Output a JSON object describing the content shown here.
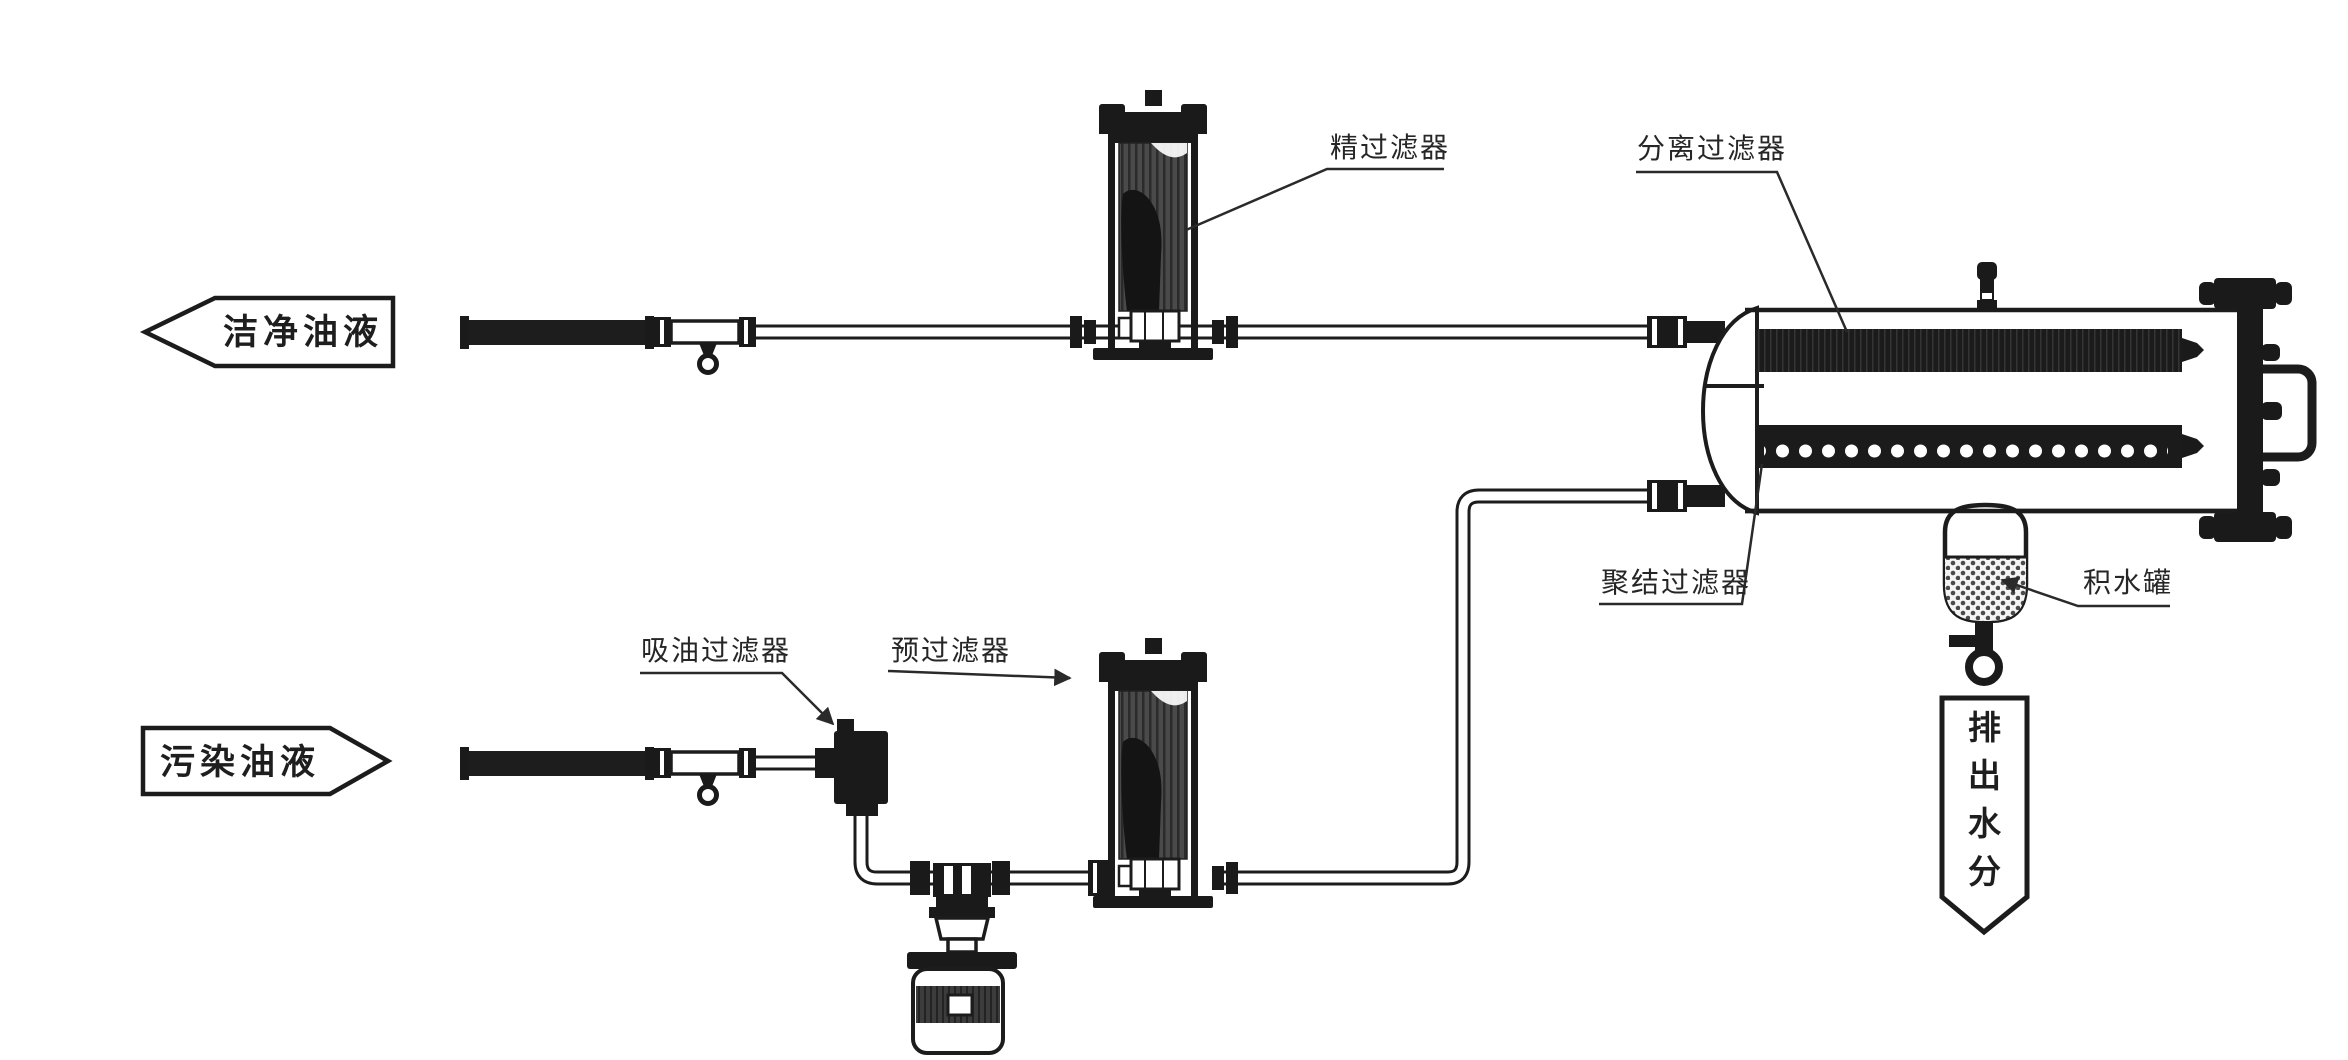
{
  "diagram": {
    "type": "oil-purification-flow-diagram",
    "banners": {
      "clean_oil": {
        "label": "洁净油液",
        "direction": "left"
      },
      "contaminated_oil": {
        "label": "污染油液",
        "direction": "right"
      },
      "discharge_water": {
        "label": "排出水分",
        "direction": "down"
      }
    },
    "labels": {
      "fine_filter": "精过滤器",
      "separation_filter": "分离过滤器",
      "suction_filter": "吸油过滤器",
      "pre_filter": "预过滤器",
      "coalescing_filter": "聚结过滤器",
      "water_tank": "积水罐"
    },
    "colors": {
      "line": "#1c1c1c",
      "fill_dark": "#1a1a1a",
      "body_gray": "#4a4a4a",
      "background": "#ffffff"
    }
  }
}
